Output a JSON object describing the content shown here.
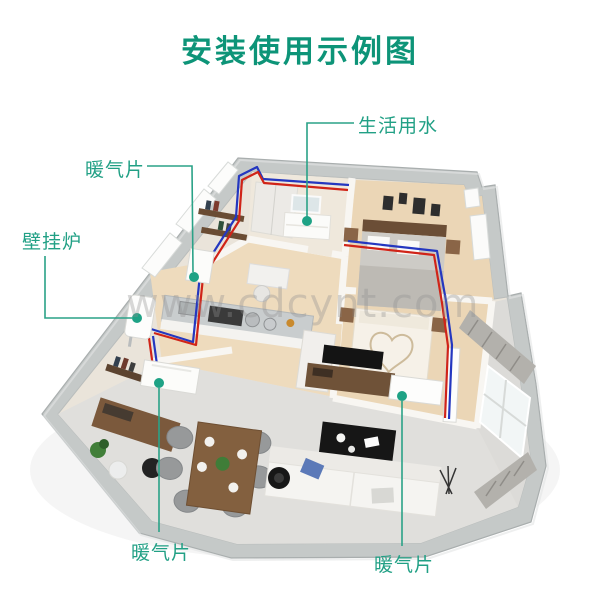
{
  "title": {
    "text": "安装使用示例图"
  },
  "watermark": {
    "text": "www.cdcynt.com"
  },
  "callouts": [
    {
      "id": "domestic-water",
      "label": "生活用水"
    },
    {
      "id": "radiator-upper-left",
      "label": "暖气片"
    },
    {
      "id": "wall-boiler",
      "label": "壁挂炉"
    },
    {
      "id": "radiator-bottom-left",
      "label": "暖气片"
    },
    {
      "id": "radiator-bottom-right",
      "label": "暖气片"
    }
  ],
  "colors": {
    "title_green": "#0d9478",
    "callout_green": "#21a085",
    "pipe_hot_red": "#d02418",
    "pipe_cold_blue": "#2437c0",
    "outer_wall_gray": "#c5c9c8",
    "interior_wall_white": "#f8f6f2",
    "wood_floor": "#ecd9b8",
    "tile_floor": "#e0dfdc",
    "watermark_gray": "#8f8f8f"
  }
}
